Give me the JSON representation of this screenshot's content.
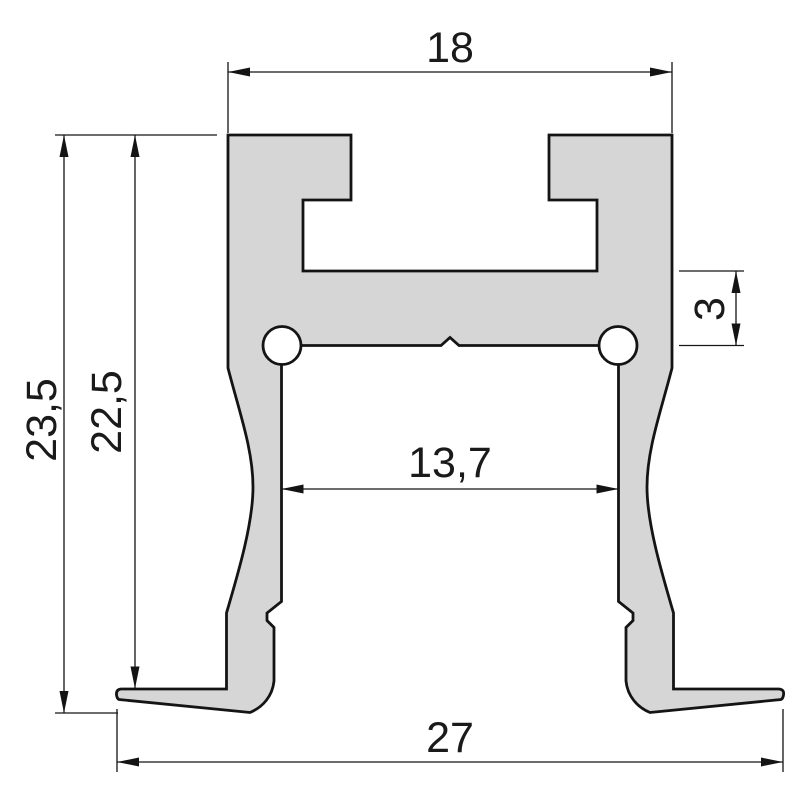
{
  "drawing": {
    "kind": "profile-cross-section",
    "background_color": "#ffffff",
    "profile_fill_color": "#d6d6d6",
    "line_color": "#141414"
  },
  "dimensions": {
    "top_width": {
      "label": "18"
    },
    "overall_height": {
      "label": "23,5"
    },
    "inner_height": {
      "label": "22,5"
    },
    "web_thickness": {
      "label": "3"
    },
    "inner_width": {
      "label": "13,7"
    },
    "overall_width": {
      "label": "27"
    }
  }
}
